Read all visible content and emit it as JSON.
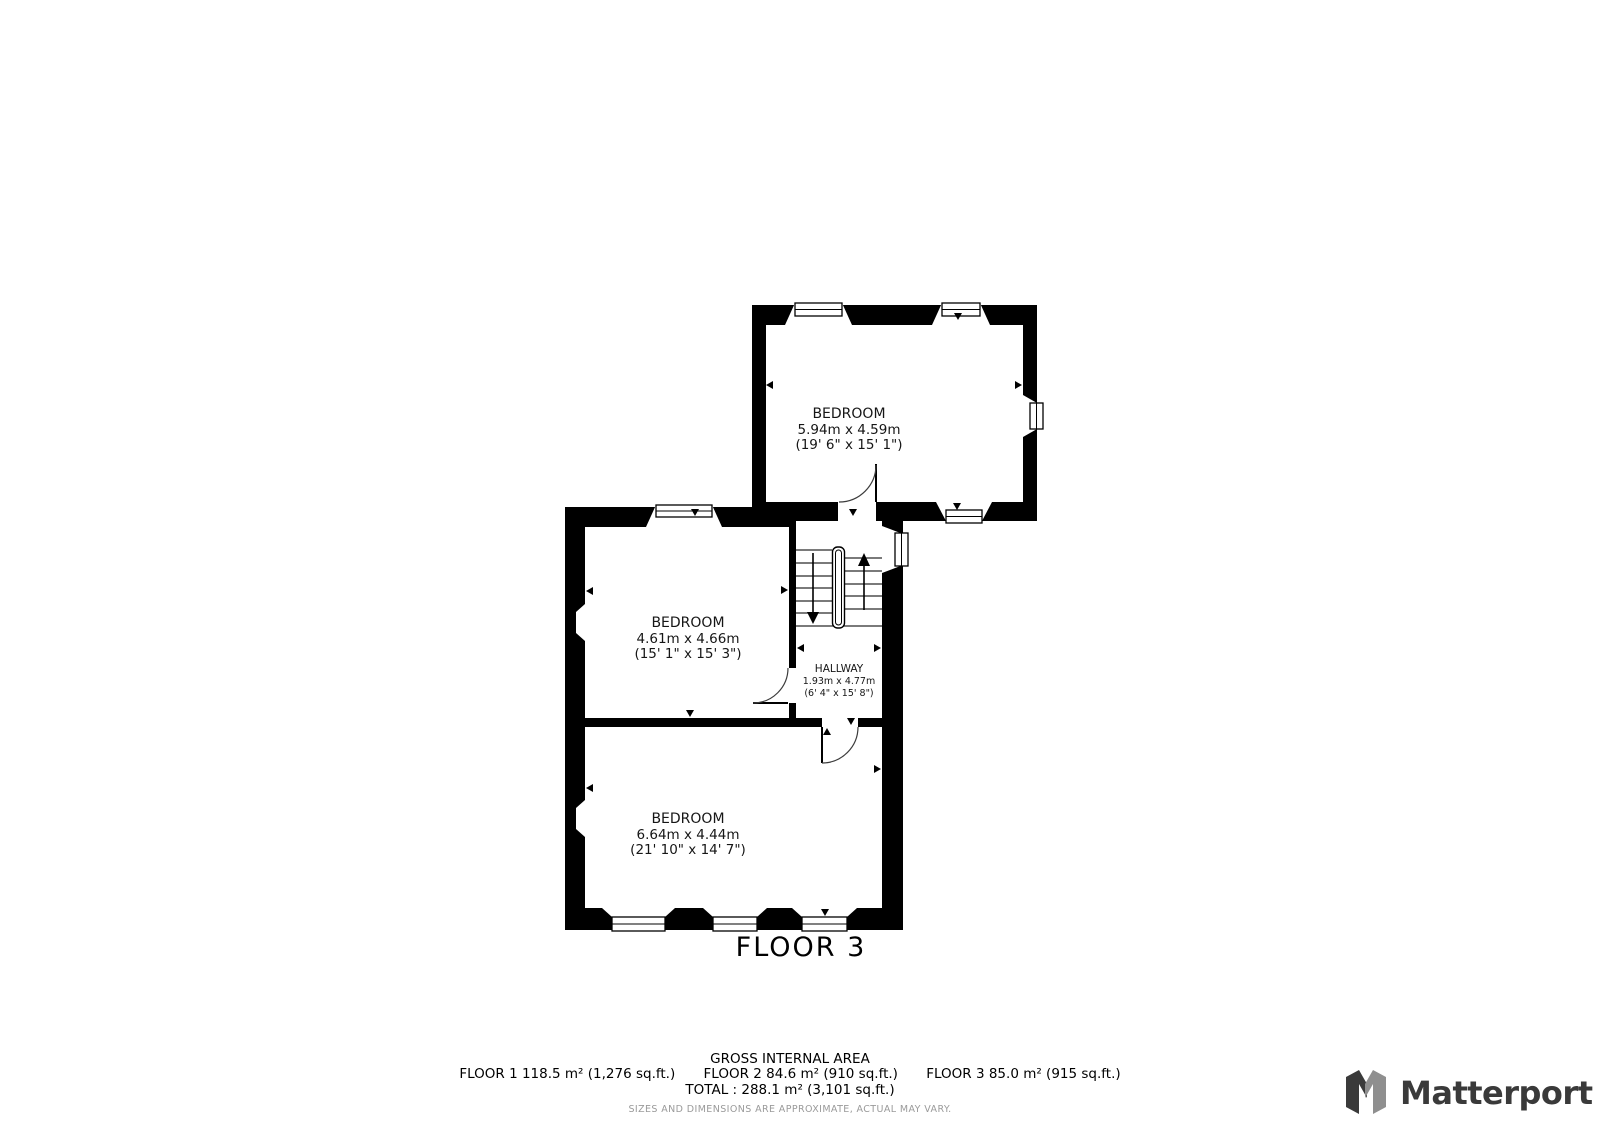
{
  "floor_title": "FLOOR 3",
  "rooms": {
    "bedroom_top": {
      "name": "BEDROOM",
      "metric": "5.94m x 4.59m",
      "imperial": "(19' 6\" x 15' 1\")"
    },
    "bedroom_mid": {
      "name": "BEDROOM",
      "metric": "4.61m x 4.66m",
      "imperial": "(15' 1\" x 15' 3\")"
    },
    "hallway": {
      "name": "HALLWAY",
      "metric": "1.93m x 4.77m",
      "imperial": "(6' 4\" x 15' 8\")"
    },
    "bedroom_bottom": {
      "name": "BEDROOM",
      "metric": "6.64m x 4.44m",
      "imperial": "(21' 10\" x 14' 7\")"
    }
  },
  "footer": {
    "gross_internal_area": "GROSS INTERNAL AREA",
    "floor1": "FLOOR 1 118.5 m² (1,276 sq.ft.)",
    "floor2": "FLOOR 2 84.6 m² (910 sq.ft.)",
    "floor3": "FLOOR 3 85.0 m² (915 sq.ft.)",
    "total": "TOTAL :  288.1 m² (3,101 sq.ft.)",
    "disclaimer": "SIZES AND DIMENSIONS ARE APPROXIMATE, ACTUAL MAY VARY."
  },
  "branding": {
    "logo_text": "Matterport"
  },
  "colors": {
    "wall": "#000000",
    "label_text": "#161616",
    "disclaimer_text": "#9a9a9a",
    "logo_dark": "#3a3a3a",
    "logo_gray": "#8f8f8f"
  }
}
